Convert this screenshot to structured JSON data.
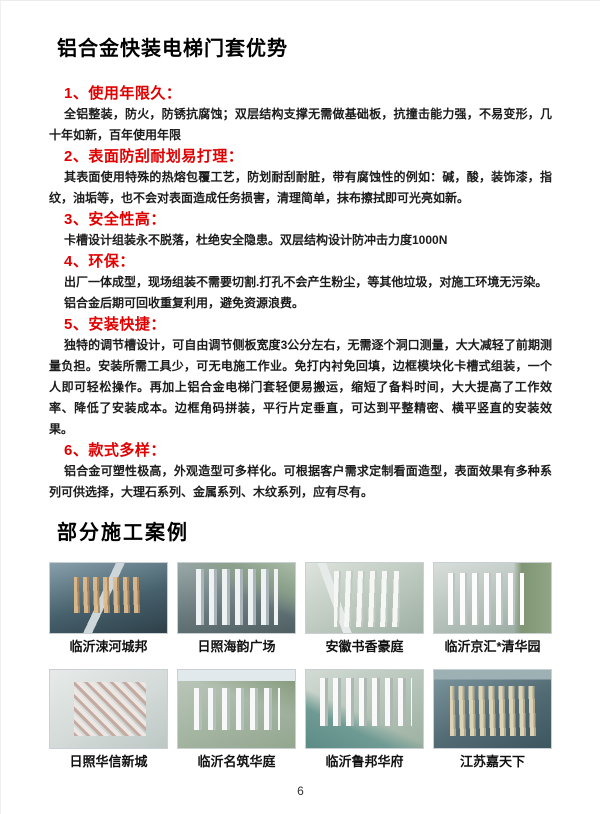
{
  "colors": {
    "accent_red": "#e00000"
  },
  "title": "铝合金快装电梯门套优势",
  "sections": [
    {
      "heading": "1、使用年限久：",
      "paragraphs": [
        "全铝整装，防火，防锈抗腐蚀；双层结构支撑无需做基础板，抗撞击能力强，不易变形，几十年如新，百年使用年限"
      ]
    },
    {
      "heading": "2、表面防刮耐划易打理：",
      "paragraphs": [
        "其表面使用特殊的热熔包覆工艺，防划耐刮耐脏，带有腐蚀性的例如：碱，酸，装饰漆，指纹，油垢等，也不会对表面造成任务损害，清理简单，抹布擦拭即可光亮如新。"
      ]
    },
    {
      "heading": "3、安全性高：",
      "paragraphs": [
        "卡槽设计组装永不脱落，杜绝安全隐患。双层结构设计防冲击力度1000N"
      ]
    },
    {
      "heading": "4、环保：",
      "paragraphs": [
        "出厂一体成型，现场组装不需要切割.打孔不会产生粉尘，等其他垃圾，对施工环境无污染。",
        "铝合金后期可回收重复利用，避免资源浪费。"
      ]
    },
    {
      "heading": "5、安装快捷：",
      "paragraphs": [
        "独特的调节槽设计，可自由调节侧板宽度3公分左右，无需逐个洞口测量，大大减轻了前期测量负担。安装所需工具少，可无电施工作业。免打内衬免回填，边框模块化卡槽式组装，一个人即可轻松操作。再加上铝合金电梯门套轻便易搬运，缩短了备料时间，大大提高了工作效率、降低了安装成本。边框角码拼装，平行片定垂直，可达到平整精密、横平竖直的安装效果。"
      ]
    },
    {
      "heading": "6、款式多样：",
      "paragraphs": [
        "铝合金可塑性极高，外观造型可多样化。可根据客户需求定制看面造型，表面效果有多种系列可供选择，大理石系列、金属系列、木纹系列，应有尽有。"
      ]
    }
  ],
  "cases": {
    "heading": "部分施工案例",
    "items": [
      {
        "caption": "临沂涑河城邦"
      },
      {
        "caption": "日照海韵广场"
      },
      {
        "caption": "安徽书香豪庭"
      },
      {
        "caption": "临沂京汇*清华园"
      },
      {
        "caption": "日照华信新城"
      },
      {
        "caption": "临沂名筑华庭"
      },
      {
        "caption": "临沂鲁邦华府"
      },
      {
        "caption": "江苏嘉天下"
      }
    ]
  },
  "page_number": "6"
}
